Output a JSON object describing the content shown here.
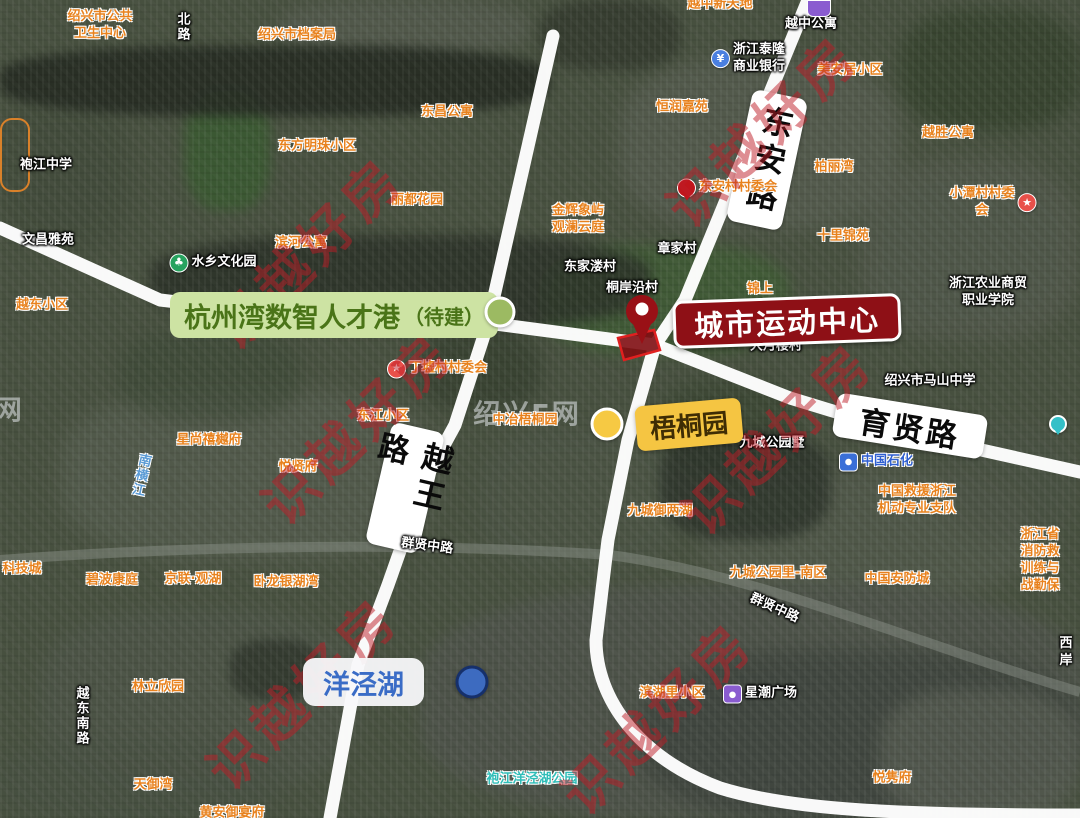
{
  "map": {
    "callouts": {
      "talent_port": {
        "title": "杭州湾数智人才港",
        "status": "（待建）"
      },
      "sports_center": {
        "title": "城市运动中心"
      },
      "wutong_garden": {
        "title": "梧桐园"
      },
      "yangjing_lake": {
        "title": "洋泾湖"
      }
    },
    "road_pills": {
      "dongan": "东安路",
      "yuewang": "越王路",
      "yuxian": "育贤路"
    },
    "watermarks": {
      "brand_text": "识越好房",
      "brand_positions": [
        [
          305,
          250
        ],
        [
          760,
          128
        ],
        [
          355,
          425
        ],
        [
          775,
          435
        ],
        [
          300,
          690
        ],
        [
          655,
          715
        ]
      ],
      "site_text": "绍兴E网",
      "site_positions": [
        [
          527,
          412
        ],
        [
          -30,
          408
        ]
      ]
    },
    "icon_glyphs": {
      "village-star": "★",
      "park-tree": "♣",
      "bank": "¥",
      "metro": "",
      "bag": "",
      "fuel": "",
      "loc-pin": ""
    },
    "pois": [
      {
        "text": "绍兴市公共\n卫生中心",
        "x": 100,
        "y": 26,
        "style": "orange"
      },
      {
        "text": "绍兴市档案局",
        "x": 297,
        "y": 36,
        "style": "orange"
      },
      {
        "text": "北路",
        "x": 181,
        "y": 27,
        "style": "white",
        "vertical": true
      },
      {
        "text": "东昌公寓",
        "x": 447,
        "y": 113,
        "style": "orange"
      },
      {
        "text": "东方明珠小区",
        "x": 317,
        "y": 147,
        "style": "orange"
      },
      {
        "text": "丽都花园",
        "x": 417,
        "y": 201,
        "style": "orange"
      },
      {
        "text": "滨河公寓",
        "x": 301,
        "y": 244,
        "style": "orange"
      },
      {
        "text": "袍江中学",
        "x": 46,
        "y": 166,
        "style": "white"
      },
      {
        "text": "文昌雅苑",
        "x": 48,
        "y": 241,
        "style": "white"
      },
      {
        "text": "水乡文化园",
        "x": 213,
        "y": 263,
        "style": "white",
        "icon": "park-tree",
        "under": true
      },
      {
        "text": "越东小区",
        "x": 42,
        "y": 306,
        "style": "orange"
      },
      {
        "text": "越中新天地",
        "x": 720,
        "y": 5,
        "style": "orange"
      },
      {
        "text": "越中公寓",
        "x": 811,
        "y": 25,
        "style": "white"
      },
      {
        "text": "浙江泰隆\n商业银行",
        "x": 748,
        "y": 59,
        "style": "white",
        "icon": "bank"
      },
      {
        "text": "美安居小区",
        "x": 850,
        "y": 71,
        "style": "orange"
      },
      {
        "text": "恒润嘉苑",
        "x": 682,
        "y": 108,
        "style": "orange"
      },
      {
        "text": "越胜公寓",
        "x": 948,
        "y": 134,
        "style": "orange"
      },
      {
        "text": "柏丽湾",
        "x": 834,
        "y": 168,
        "style": "orange"
      },
      {
        "text": "十里锦苑",
        "x": 843,
        "y": 237,
        "style": "orange"
      },
      {
        "text": "东安村村委会",
        "x": 727,
        "y": 188,
        "style": "orange",
        "icon": "loc-pin"
      },
      {
        "text": "小潭村村委会",
        "x": 993,
        "y": 203,
        "style": "orange",
        "icon": "village-star",
        "iconSide": "right"
      },
      {
        "text": "金辉象屿\n观澜云庭",
        "x": 578,
        "y": 220,
        "style": "orange"
      },
      {
        "text": "章家村",
        "x": 677,
        "y": 250,
        "style": "white"
      },
      {
        "text": "东家溇村",
        "x": 590,
        "y": 268,
        "style": "white"
      },
      {
        "text": "桐岸沿村",
        "x": 632,
        "y": 289,
        "style": "white"
      },
      {
        "text": "锦上",
        "x": 760,
        "y": 290,
        "style": "orange"
      },
      {
        "text": "大月楼村",
        "x": 776,
        "y": 347,
        "style": "white"
      },
      {
        "text": "丁墟村村委会",
        "x": 437,
        "y": 369,
        "style": "orange",
        "icon": "village-star"
      },
      {
        "text": "浙江农业商贸\n职业学院",
        "x": 988,
        "y": 293,
        "style": "white"
      },
      {
        "text": "绍兴市马山中学",
        "x": 930,
        "y": 382,
        "style": "white"
      },
      {
        "text": "东江小区",
        "x": 383,
        "y": 417,
        "style": "orange"
      },
      {
        "text": "中冶梧桐园",
        "x": 525,
        "y": 421,
        "style": "orange"
      },
      {
        "text": "星尚禧樾府",
        "x": 209,
        "y": 441,
        "style": "orange"
      },
      {
        "text": "悦贤府",
        "x": 298,
        "y": 468,
        "style": "orange"
      },
      {
        "text": "南横江",
        "x": 139,
        "y": 475,
        "style": "blue",
        "vertical": true,
        "rot": 12
      },
      {
        "text": "九城公园墅",
        "x": 772,
        "y": 444,
        "style": "white"
      },
      {
        "text": "中国石化",
        "x": 876,
        "y": 462,
        "style": "sinopec",
        "icon": "fuel"
      },
      {
        "text": "中国救援浙江\n机动专业支队",
        "x": 917,
        "y": 501,
        "style": "orange"
      },
      {
        "text": "九城御两湖",
        "x": 660,
        "y": 512,
        "style": "orange"
      },
      {
        "text": "群贤中路",
        "x": 427,
        "y": 547,
        "style": "white",
        "rot": 7
      },
      {
        "text": "科技城",
        "x": 22,
        "y": 570,
        "style": "orange"
      },
      {
        "text": "碧波康庭",
        "x": 112,
        "y": 581,
        "style": "orange"
      },
      {
        "text": "京联·观湖",
        "x": 193,
        "y": 580,
        "style": "orange"
      },
      {
        "text": "卧龙银湖湾",
        "x": 286,
        "y": 583,
        "style": "orange"
      },
      {
        "text": "九城公园里-南区",
        "x": 778,
        "y": 574,
        "style": "orange"
      },
      {
        "text": "中国安防城",
        "x": 897,
        "y": 580,
        "style": "orange"
      },
      {
        "text": "浙江省消防救\n训练与战勤保",
        "x": 1040,
        "y": 561,
        "style": "orange"
      },
      {
        "text": "群贤中路",
        "x": 774,
        "y": 609,
        "style": "white",
        "rot": 24
      },
      {
        "text": "西岸",
        "x": 1066,
        "y": 653,
        "style": "white"
      },
      {
        "text": "林立欣园",
        "x": 158,
        "y": 688,
        "style": "orange"
      },
      {
        "text": "越东南路",
        "x": 80,
        "y": 716,
        "style": "white",
        "vertical": true
      },
      {
        "text": "滨湖里小区",
        "x": 672,
        "y": 694,
        "style": "orange"
      },
      {
        "text": "星潮广场",
        "x": 760,
        "y": 694,
        "style": "white",
        "icon": "bag"
      },
      {
        "text": "袍江洋泾湖公园",
        "x": 532,
        "y": 780,
        "style": "teal"
      },
      {
        "text": "悦隽府",
        "x": 892,
        "y": 779,
        "style": "orange"
      },
      {
        "text": "天御湾",
        "x": 153,
        "y": 786,
        "style": "orange"
      },
      {
        "text": "黄安御宴府",
        "x": 232,
        "y": 814,
        "style": "orange"
      }
    ]
  }
}
